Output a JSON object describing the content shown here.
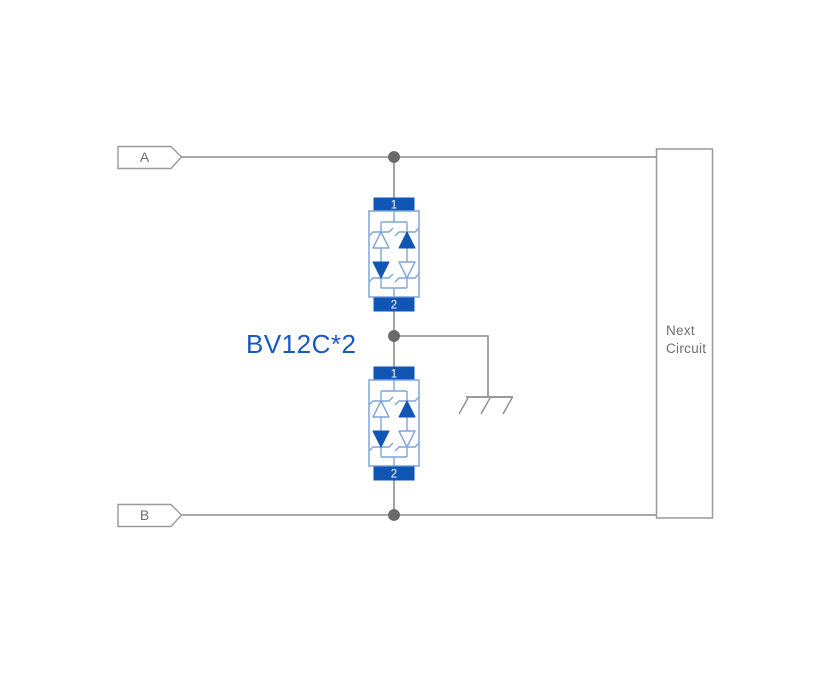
{
  "diagram": {
    "net_labels": {
      "a": "A",
      "b": "B"
    },
    "part_label": "BV12C*2",
    "components": [
      {
        "pin_top": "1",
        "pin_bottom": "2"
      },
      {
        "pin_top": "1",
        "pin_bottom": "2"
      }
    ],
    "next_circuit": {
      "line1": "Next",
      "line2": "Circuit"
    },
    "colors": {
      "component_blue": "#1056b4",
      "component_light_blue": "#7ea6d8",
      "label_blue": "#1659c2",
      "wire_gray": "#8c8c8c",
      "junction_gray": "#6b6b6b",
      "outline_gray": "#9a9a9a",
      "text_gray": "#6e6e6e",
      "background": "#ffffff"
    }
  }
}
